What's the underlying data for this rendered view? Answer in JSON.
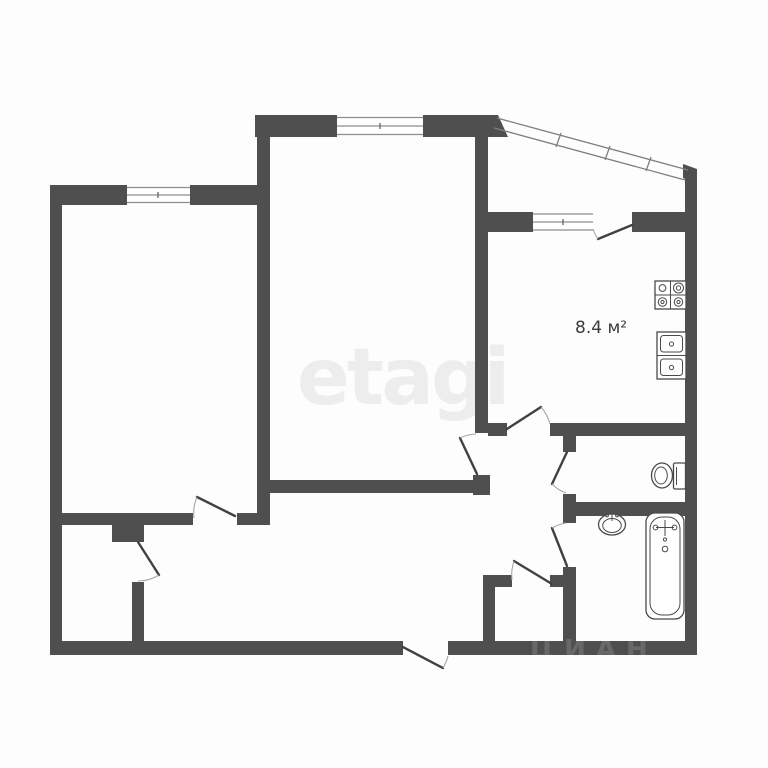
{
  "image": {
    "type": "floor-plan",
    "background": "#fdfdfd"
  },
  "colors": {
    "wall": "#4f4f4f",
    "door_line": "#414141",
    "swing_arc": "#a6a6a6",
    "window_line": "#8d8d8d",
    "fixture_line": "#4a4a4a",
    "label_text": "#3b3b3b",
    "watermark_main": "#ededed"
  },
  "labels": {
    "kitchen_area": "8.4 м²"
  },
  "watermarks": {
    "center": "etagi",
    "bottom": "ЦИАН"
  },
  "fixtures": {
    "kitchen": [
      "stove-icon",
      "double-sink-icon"
    ],
    "wc": [
      "toilet-icon"
    ],
    "bathroom": [
      "washbasin-icon",
      "bathtub-icon"
    ]
  },
  "counts": {
    "windows": 3,
    "doors": 9,
    "rooms": 7
  }
}
